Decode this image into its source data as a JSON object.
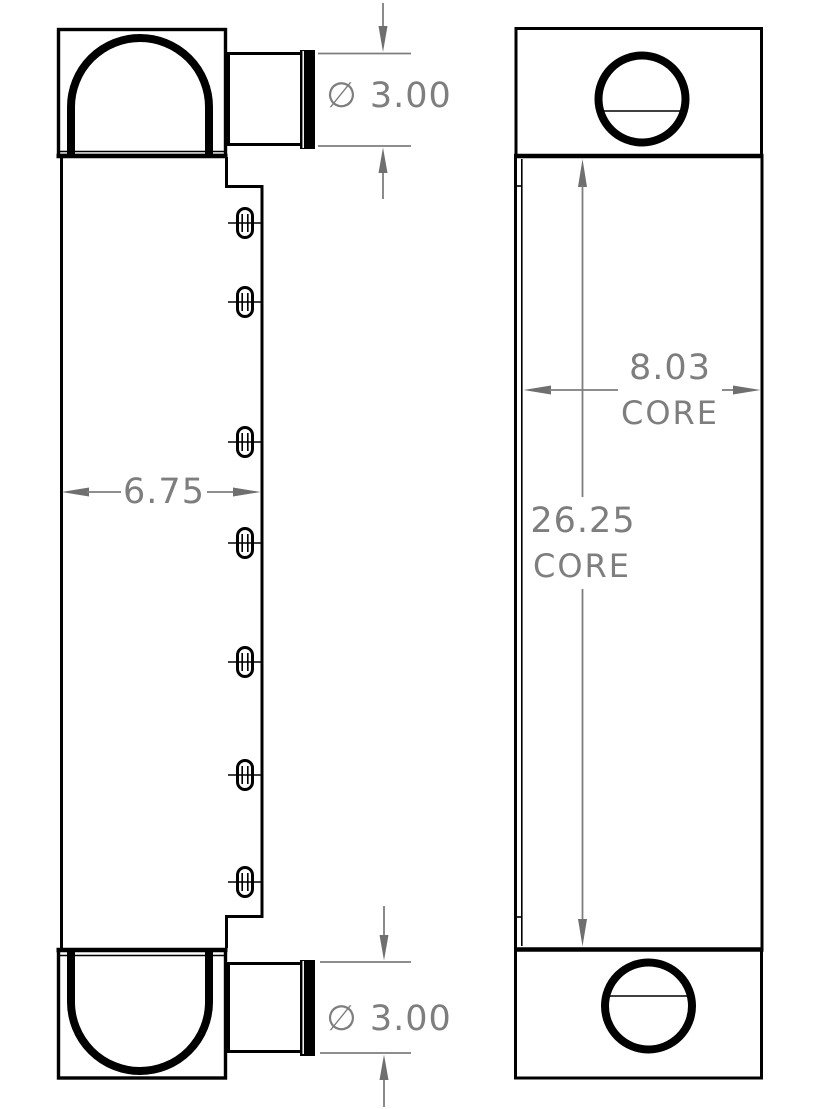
{
  "colors": {
    "line": "#000000",
    "dimension": "#7e7e7e",
    "arrow": "#6f6f6f"
  },
  "views": {
    "side_view": {
      "name": "side view (left)",
      "slots": {
        "center_x": 245,
        "centers_y": [
          223,
          302,
          442,
          543,
          662,
          775,
          882
        ],
        "width": 15,
        "height": 29
      }
    },
    "front_view": {
      "name": "front view (right)"
    }
  },
  "dimensions": {
    "top_port_diameter": {
      "label": "∅ 3.00"
    },
    "bottom_port_diameter": {
      "label": "∅ 3.00"
    },
    "overall_width": {
      "label": "6.75"
    },
    "core_width": {
      "value": "8.03",
      "suffix": "CORE"
    },
    "core_height": {
      "value": "26.25",
      "suffix": "CORE"
    }
  }
}
